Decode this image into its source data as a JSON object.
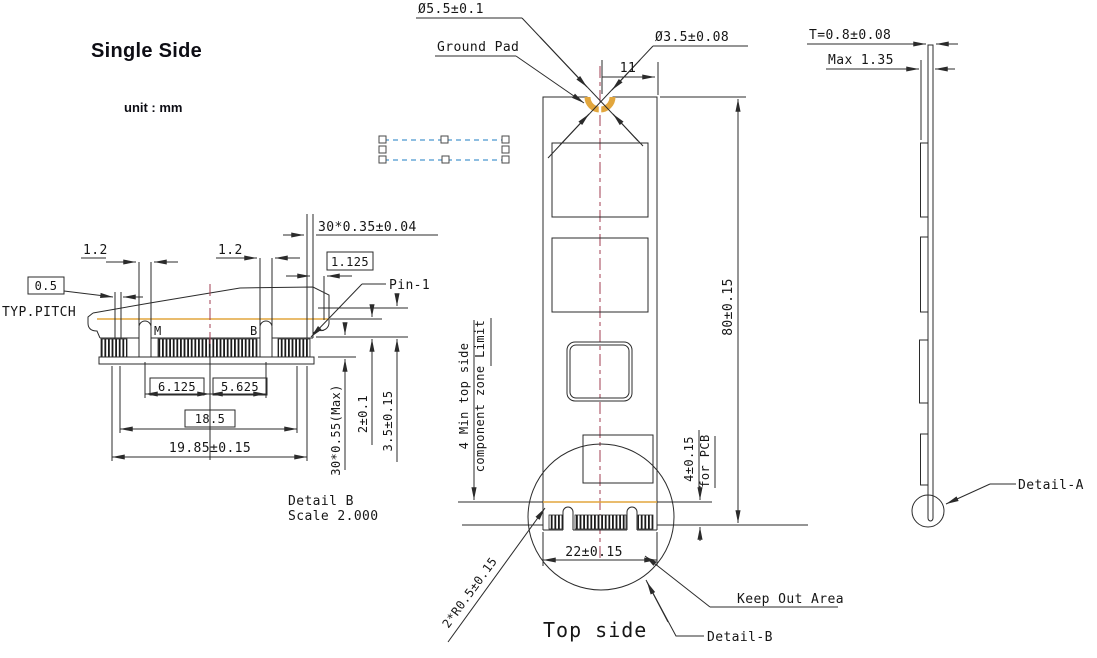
{
  "colors": {
    "line": "#2b2b2b",
    "gold": "#e2a63d",
    "center": "#a03c50",
    "marquee": "#4a97cf"
  },
  "title": "Single Side",
  "unit_note": "unit : mm",
  "ground_pad_callout": {
    "outer_dia": "Ø5.5±0.1",
    "label": "Ground Pad",
    "inner_dia": "Ø3.5±0.08",
    "center_offset": "11"
  },
  "side_view": {
    "thickness": "T=0.8±0.08",
    "max_height": "Max 1.35",
    "detail_ref": "Detail-A"
  },
  "top_view": {
    "length": "80±0.15",
    "width": "22±0.15",
    "pcb_dim": "4±0.15",
    "pcb_dim_suffix": "for PCB",
    "zone_line1": "4 Min top side",
    "zone_line2": "component zone Limit",
    "keep_out": "Keep Out Area",
    "detail_ref": "Detail-B",
    "caption": "Top side",
    "corner_radius": "2*R0.5±0.15"
  },
  "detail_b": {
    "pitch_value": "0.5",
    "pitch_label": "TYP.PITCH",
    "gap_left": "1.2",
    "gap_right": "1.2",
    "pad_width": "30*0.35±0.04",
    "edge_pad": "1.125",
    "pin1": "Pin-1",
    "key_m": "M",
    "key_b": "B",
    "dim_m_center": "6.125",
    "dim_b_center": "5.625",
    "dim_inner": "18.5",
    "dim_overall": "19.85±0.15",
    "pad_height": "30*0.55(Max)",
    "dim_height_2": "2±0.1",
    "dim_height_35": "3.5±0.15",
    "caption_line1": "Detail B",
    "caption_line2": "Scale 2.000"
  }
}
